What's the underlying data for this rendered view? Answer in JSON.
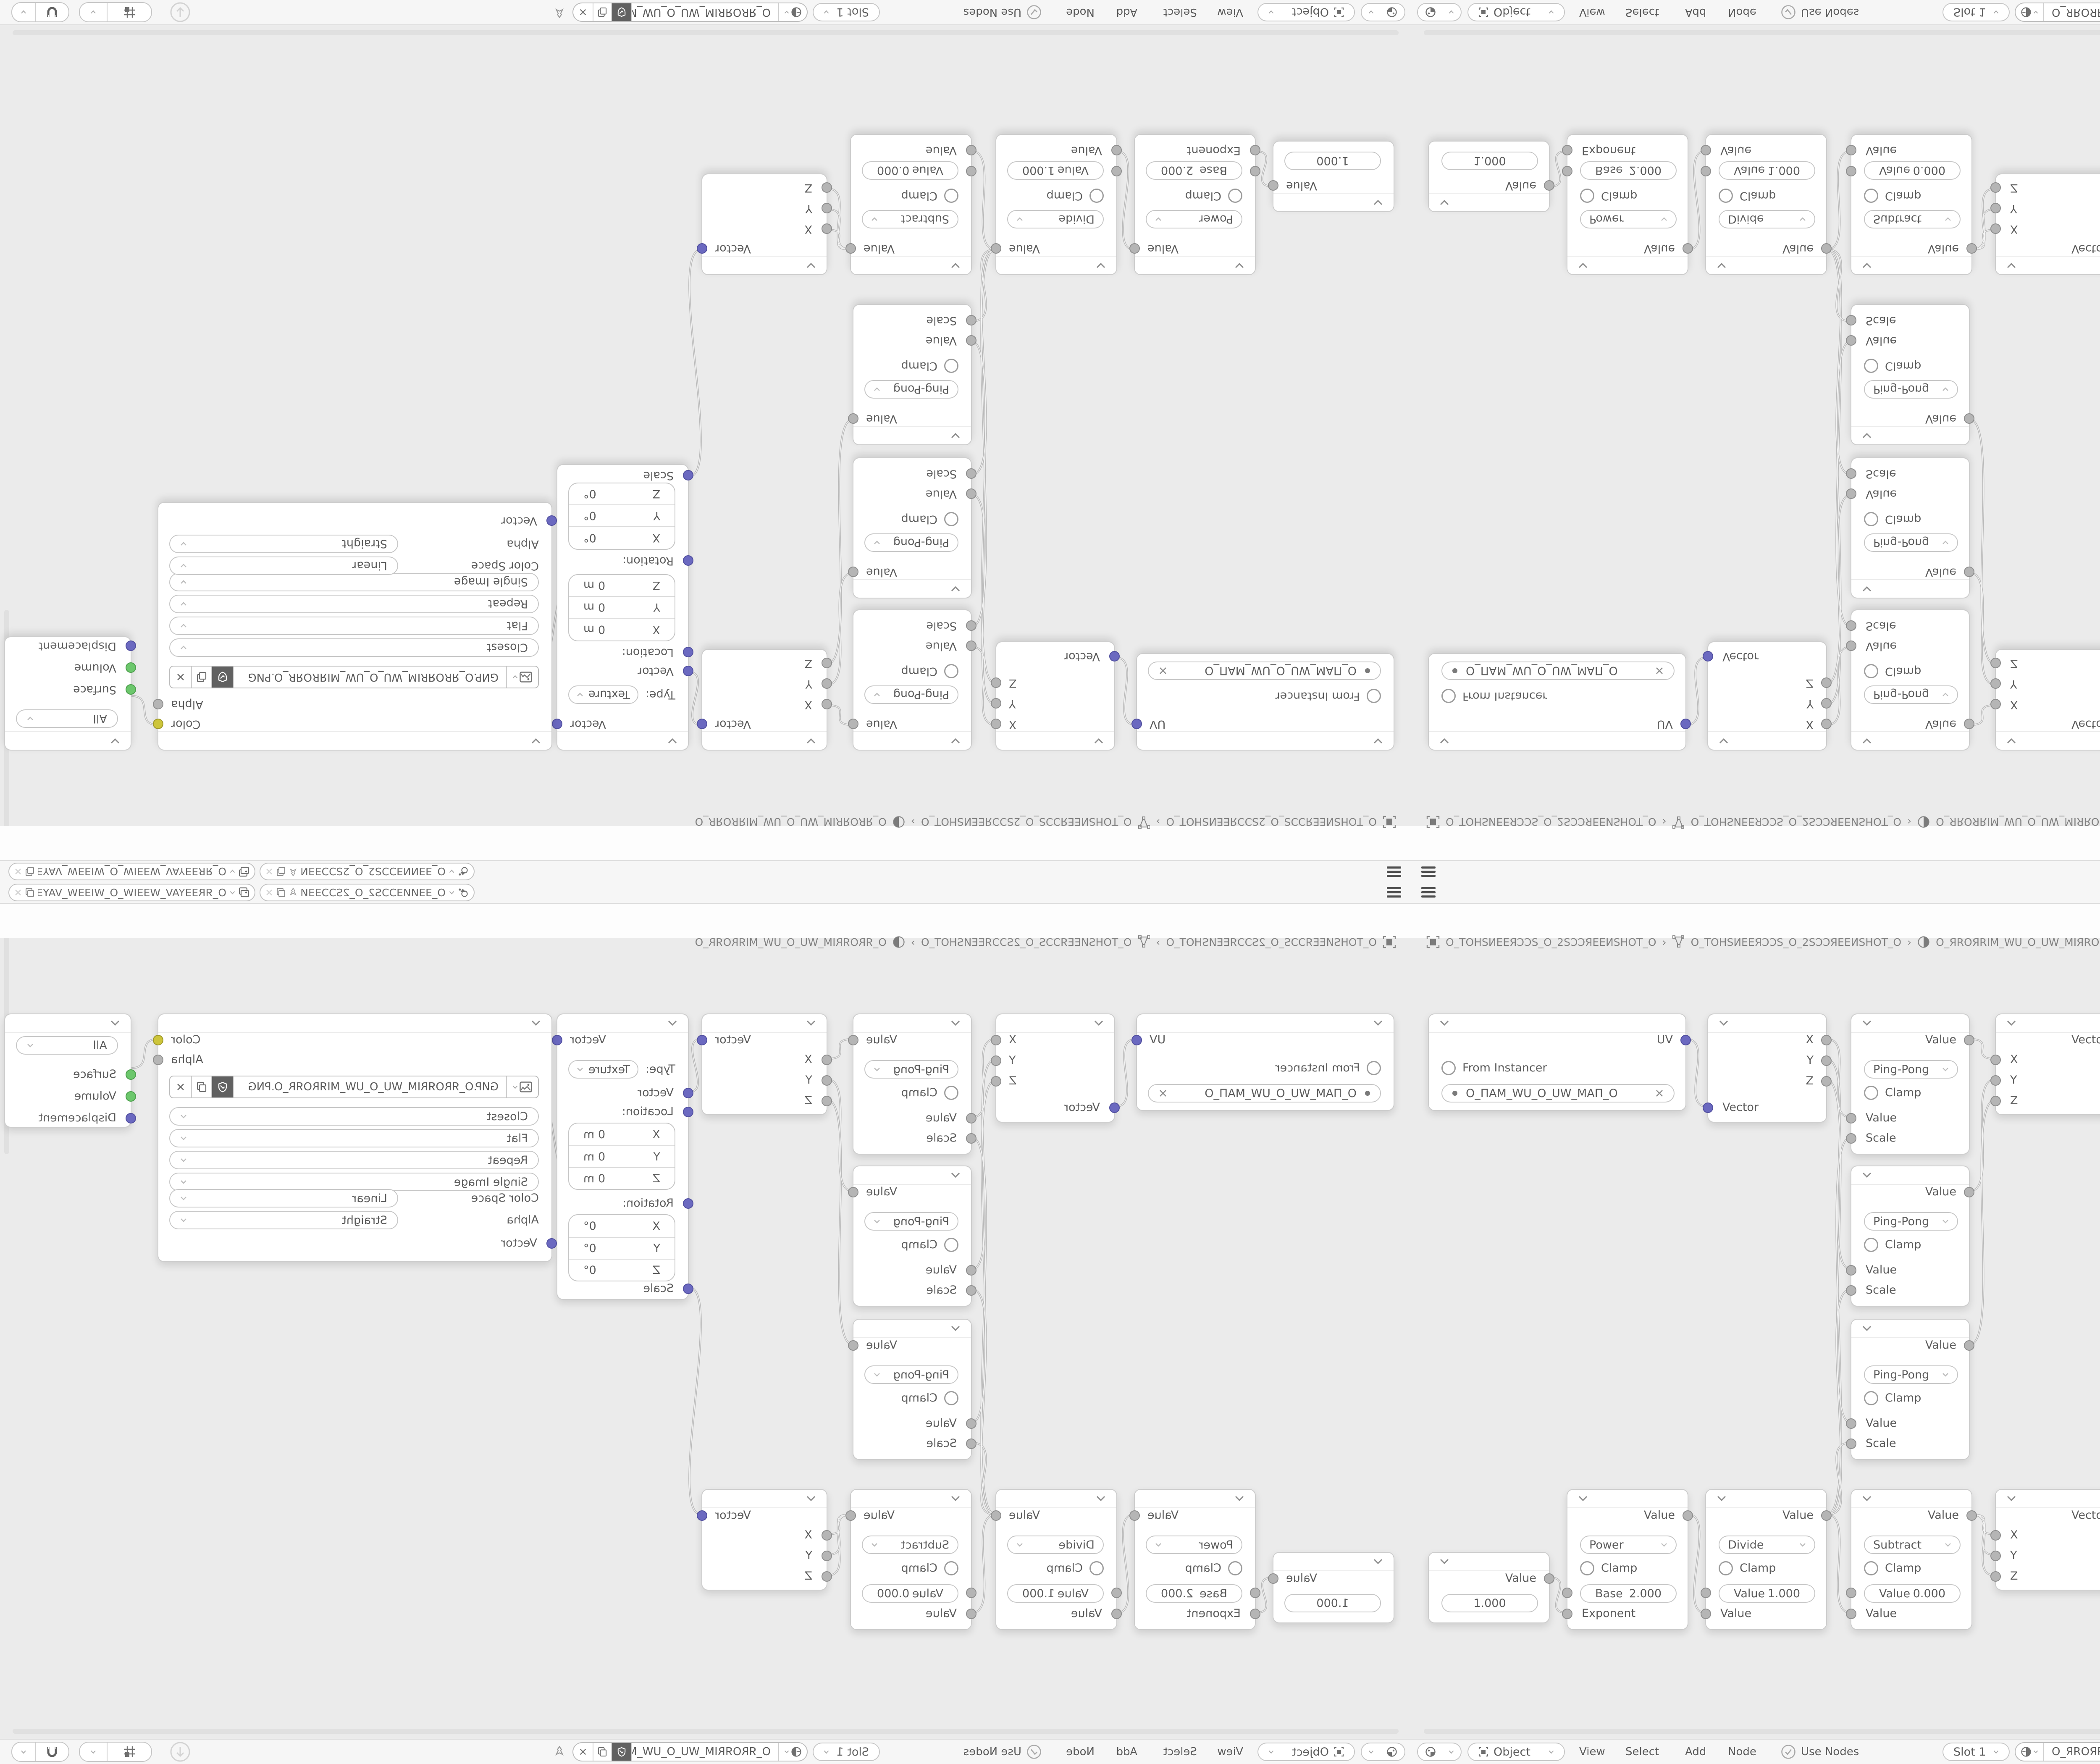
{
  "topbar": {
    "scene": "O_ƎƎИИƎƆƆS2_O_2SƆƆƎƎИ…",
    "view_layer": "O_ЯRƎƎYAV_WƎƎIW_O_WIƎƎW_VAYƎƎR_O"
  },
  "breadcrumb": {
    "screen": "O_TOHSИEEЯƆƆS_O_2SƆƆЯEEИSHOT_O",
    "scene": "O_TOHSИEEЯƆƆS_O_2SƆƆЯEEИSHOT_O",
    "material": "O_ЯROЯRIM_WU_O_UW_MIЯROЯR_O",
    "separator": "›"
  },
  "editor_header": {
    "mode": "Object",
    "menu_view": "View",
    "menu_select": "Select",
    "menu_add": "Add",
    "menu_node": "Node",
    "use_nodes": "Use Nodes",
    "slot": "Slot 1",
    "material": "O_ЯROЯRIM_WU_O_UW_MIЯROЯR_O"
  },
  "nodes": {
    "uv_map": {
      "out_uv": "UV",
      "from_instancer": "From Instancer",
      "uv_map_name": "O_ПAM_WU_O_UW_MAП_O"
    },
    "separate_xyz": {
      "out_x": "X",
      "out_y": "Y",
      "out_z": "Z",
      "in_vector": "Vector"
    },
    "ping_pong": {
      "out_value": "Value",
      "operation": "Ping-Pong",
      "clamp": "Clamp",
      "in_value": "Value",
      "in_scale": "Scale"
    },
    "combine_xyz": {
      "out_vector": "Vector",
      "in_x": "X",
      "in_y": "Y",
      "in_z": "Z"
    },
    "mapping": {
      "out_vector": "Vector",
      "type_label": "Type:",
      "type_value": "Texture",
      "in_vector": "Vector",
      "location_label": "Location:",
      "rotation_label": "Rotation:",
      "scale_label": "Scale",
      "axis_x": "X",
      "axis_y": "Y",
      "axis_z": "Z",
      "loc_value": "0 m",
      "rot_value": "0°"
    },
    "image_texture": {
      "out_color": "Color",
      "out_alpha": "Alpha",
      "filename": "GИP.O_ЯROЯRIM_WU_O_UW_MIЯROЯR_O.PNG",
      "interpolation": "Closest",
      "projection": "Flat",
      "extension": "Repeat",
      "source": "Single Image",
      "color_space_label": "Color Space",
      "color_space": "Linear",
      "alpha_label": "Alpha",
      "alpha_mode": "Straight",
      "in_vector": "Vector"
    },
    "material_output": {
      "target": "All",
      "in_surface": "Surface",
      "in_volume": "Volume",
      "in_displacement": "Displacement"
    },
    "value": {
      "out_value": "Value",
      "value": "1.000"
    },
    "power": {
      "out_value": "Value",
      "operation": "Power",
      "clamp": "Clamp",
      "field_label": "Base",
      "field_value": "2.000",
      "in_exponent": "Exponent"
    },
    "divide": {
      "out_value": "Value",
      "operation": "Divide",
      "clamp": "Clamp",
      "field_label": "Value",
      "field_value": "1.000",
      "in_value": "Value"
    },
    "subtract": {
      "out_value": "Value",
      "operation": "Subtract",
      "clamp": "Clamp",
      "field_label": "Value",
      "field_value": "0.000",
      "in_value": "Value"
    }
  },
  "colors": {
    "vector_socket": "#6b69c0",
    "value_socket": "#b5b5b5",
    "color_socket": "#cdc53b",
    "shader_socket": "#6cc76c",
    "accent_wire": "#b5b5b5"
  }
}
